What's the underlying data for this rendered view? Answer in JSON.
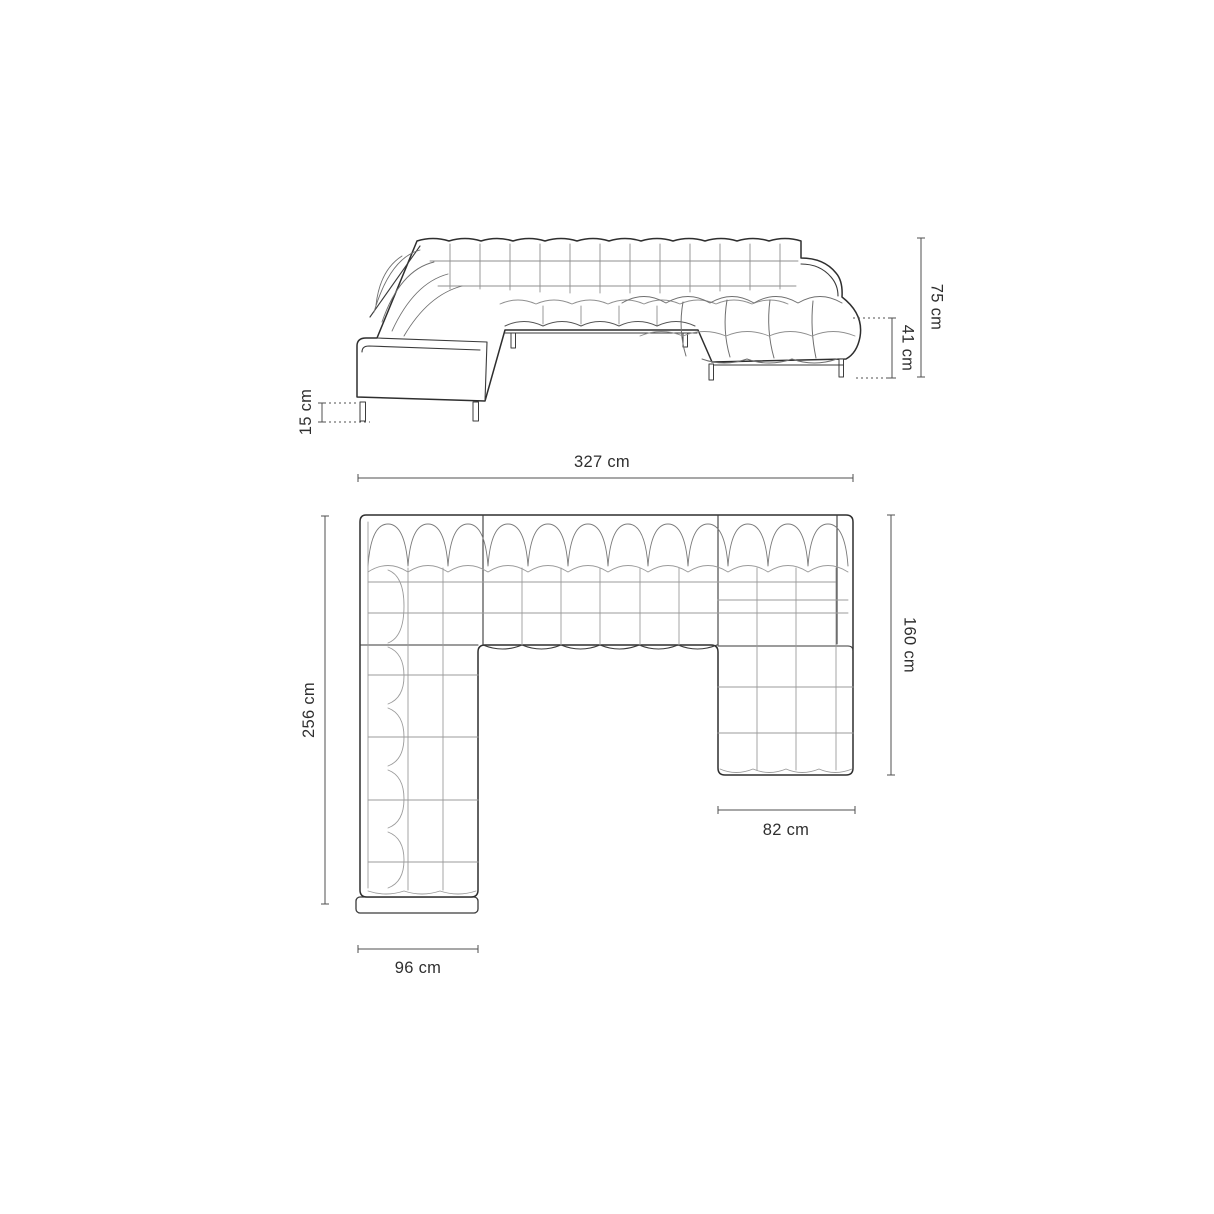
{
  "colors": {
    "outline": "#2e2e2e",
    "tuft_line": "#8f8f8f",
    "dimension_line": "#4f4f4f",
    "label_text": "#2f2f2f",
    "background": "#ffffff"
  },
  "dimensions": {
    "front_view": {
      "total_height": "75 cm",
      "seat_height": "41 cm",
      "leg_height": "15 cm"
    },
    "top_view": {
      "total_width": "327 cm",
      "total_depth": "256 cm",
      "chaise_depth": "160 cm",
      "chaise_bottom_width": "82 cm",
      "arm_bottom_width": "96 cm"
    }
  }
}
